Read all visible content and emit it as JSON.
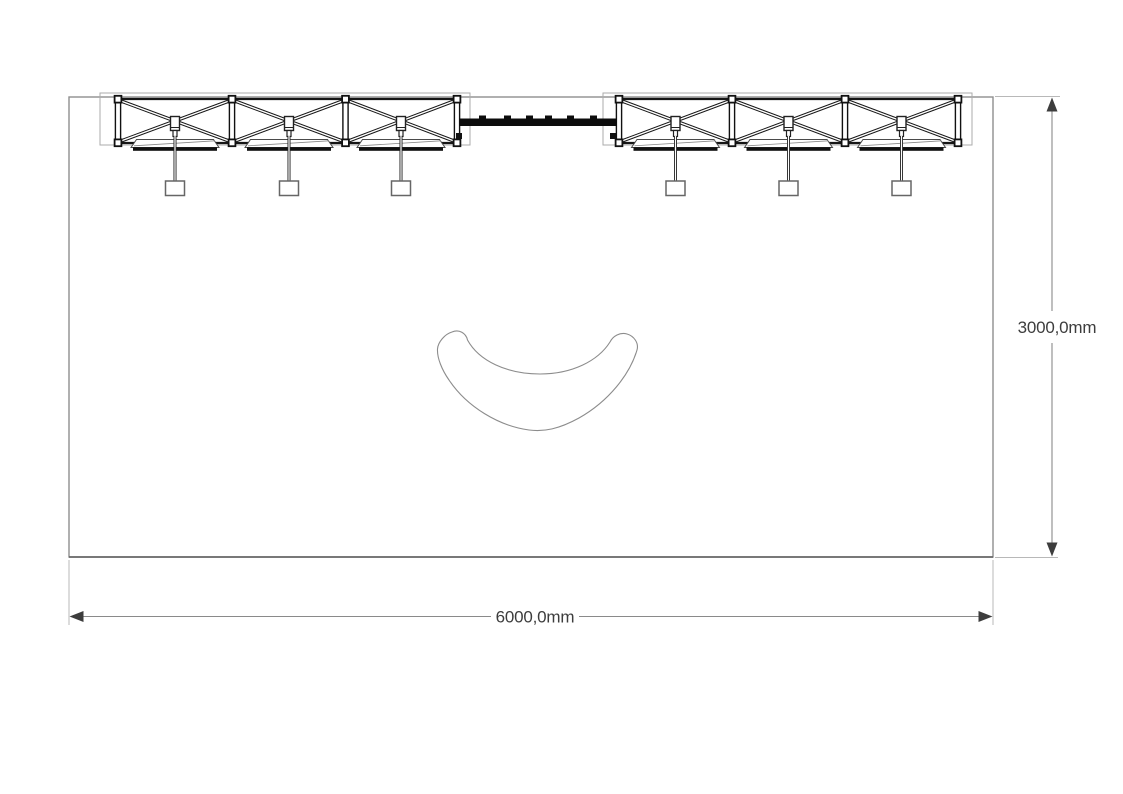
{
  "page": {
    "type": "exhibition-stand-floor-plan",
    "background": "#ffffff"
  },
  "dimensions": {
    "width_label": "6000,0mm",
    "height_label": "3000,0mm"
  },
  "booth": {
    "width_mm": "6000,0",
    "depth_mm": "3000,0"
  },
  "rigging": {
    "trusses": [
      {
        "id": "truss-left",
        "segments": 3,
        "spotlights": 3,
        "shelves": 3
      },
      {
        "id": "truss-right",
        "segments": 3,
        "spotlights": 3,
        "shelves": 3
      }
    ],
    "center_beam": {
      "clamps": 6
    }
  },
  "furniture": {
    "counter": {
      "shape": "curved-kidney-counter"
    }
  },
  "colors": {
    "boundary": "#8f8f8f",
    "boundary_bottom": "#6b6b6b",
    "truss": "#161616",
    "truss_frame": "#ababab",
    "beam": "#0c0c0c",
    "shelf_edge": "#4a4a4a",
    "dimension_line": "#8a8a8a",
    "extension_line": "#b8b8b8",
    "dimension_text": "#3d3d3d",
    "counter_outline": "#8c8c8c"
  }
}
